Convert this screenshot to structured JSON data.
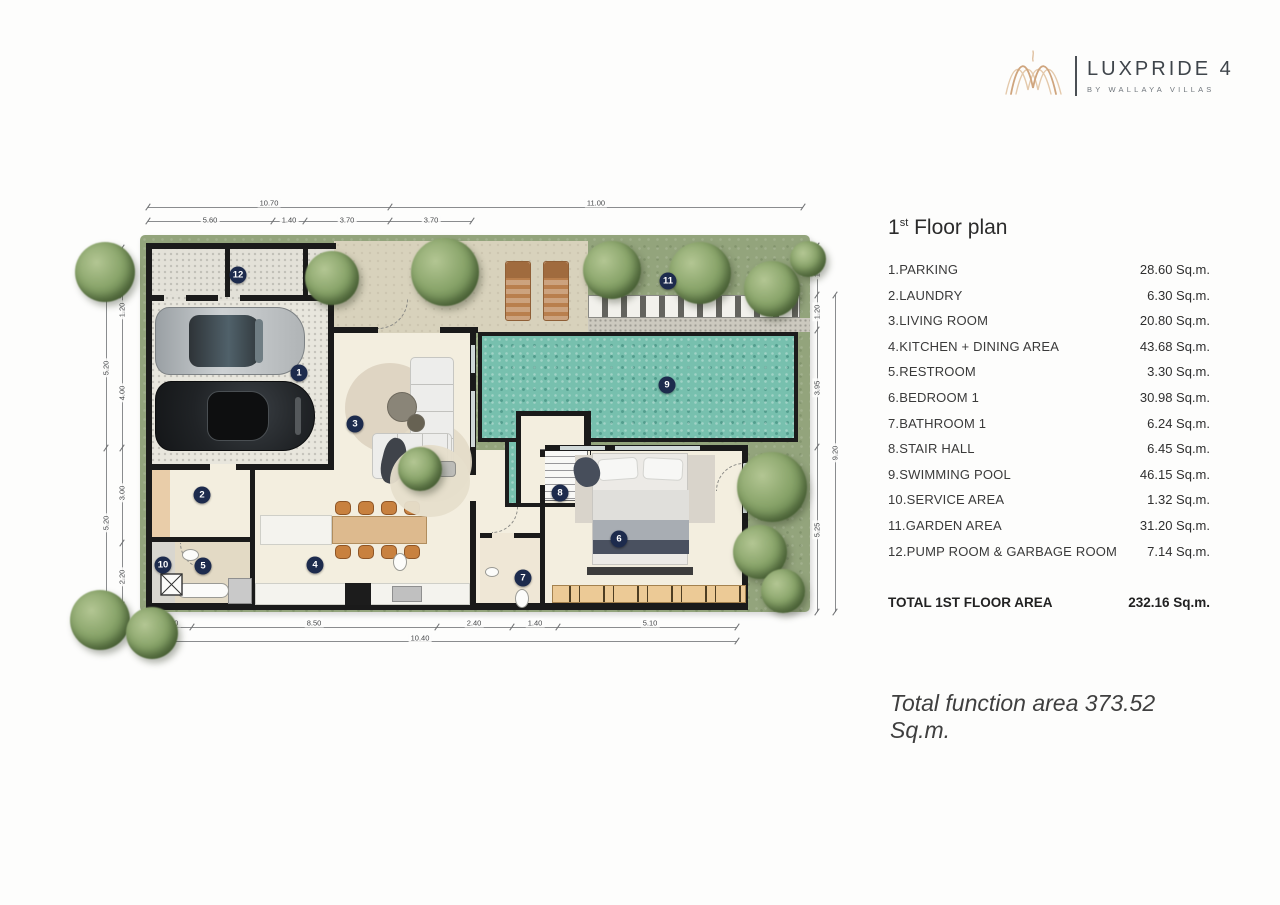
{
  "logo": {
    "brand": "LUXPRIDE 4",
    "sub": "BY WALLAYA VILLAS"
  },
  "panel": {
    "title": {
      "num": "1",
      "sup": "st",
      "rest": " Floor plan"
    },
    "items": [
      {
        "label": "1.PARKING",
        "area": "28.60 Sq.m."
      },
      {
        "label": "2.LAUNDRY",
        "area": "6.30 Sq.m."
      },
      {
        "label": "3.LIVING ROOM",
        "area": "20.80 Sq.m."
      },
      {
        "label": "4.KITCHEN + DINING AREA",
        "area": "43.68 Sq.m."
      },
      {
        "label": "5.RESTROOM",
        "area": "3.30 Sq.m."
      },
      {
        "label": "6.BEDROOM 1",
        "area": "30.98 Sq.m."
      },
      {
        "label": "7.BATHROOM 1",
        "area": "6.24 Sq.m."
      },
      {
        "label": "8.STAIR HALL",
        "area": "6.45 Sq.m."
      },
      {
        "label": "9.SWIMMING POOL",
        "area": "46.15 Sq.m."
      },
      {
        "label": "10.SERVICE AREA",
        "area": "1.32 Sq.m."
      },
      {
        "label": "11.GARDEN AREA",
        "area": "31.20 Sq.m."
      },
      {
        "label": "12.PUMP ROOM & GARBAGE ROOM",
        "area": "7.14 Sq.m."
      }
    ],
    "total_label": "TOTAL 1ST FLOOR AREA",
    "total_area": "232.16 Sq.m.",
    "total_function": "Total function area 373.52 Sq.m."
  },
  "plan": {
    "markers": [
      {
        "n": "1",
        "x": 239,
        "y": 178
      },
      {
        "n": "2",
        "x": 142,
        "y": 300
      },
      {
        "n": "3",
        "x": 295,
        "y": 229
      },
      {
        "n": "4",
        "x": 255,
        "y": 370
      },
      {
        "n": "5",
        "x": 143,
        "y": 371
      },
      {
        "n": "6",
        "x": 559,
        "y": 344
      },
      {
        "n": "7",
        "x": 463,
        "y": 383
      },
      {
        "n": "8",
        "x": 500,
        "y": 298
      },
      {
        "n": "9",
        "x": 607,
        "y": 190
      },
      {
        "n": "10",
        "x": 103,
        "y": 370
      },
      {
        "n": "11",
        "x": 608,
        "y": 86
      },
      {
        "n": "12",
        "x": 178,
        "y": 80
      }
    ],
    "dimensions": [
      {
        "v": "10.70",
        "x": 209,
        "y": 8,
        "rot": false
      },
      {
        "v": "11.00",
        "x": 536,
        "y": 8,
        "rot": false
      },
      {
        "v": "5.60",
        "x": 150,
        "y": 25,
        "rot": false
      },
      {
        "v": "1.40",
        "x": 229,
        "y": 25,
        "rot": false
      },
      {
        "v": "3.70",
        "x": 287,
        "y": 25,
        "rot": false
      },
      {
        "v": "3.70",
        "x": 371,
        "y": 25,
        "rot": false
      },
      {
        "v": "1.40",
        "x": 111,
        "y": 428,
        "rot": false
      },
      {
        "v": "8.50",
        "x": 254,
        "y": 428,
        "rot": false
      },
      {
        "v": "2.40",
        "x": 414,
        "y": 428,
        "rot": false
      },
      {
        "v": "1.40",
        "x": 475,
        "y": 428,
        "rot": false
      },
      {
        "v": "5.10",
        "x": 590,
        "y": 428,
        "rot": false
      },
      {
        "v": "10.40",
        "x": 360,
        "y": 443,
        "rot": false
      },
      {
        "v": "1.20",
        "x": 62,
        "y": 115,
        "rot": true
      },
      {
        "v": "4.00",
        "x": 62,
        "y": 198,
        "rot": true
      },
      {
        "v": "3.00",
        "x": 62,
        "y": 298,
        "rot": true
      },
      {
        "v": "2.20",
        "x": 62,
        "y": 382,
        "rot": true
      },
      {
        "v": "5.20",
        "x": 46,
        "y": 173,
        "rot": true
      },
      {
        "v": "5.20",
        "x": 46,
        "y": 328,
        "rot": true
      },
      {
        "v": "1.65",
        "x": 757,
        "y": 75,
        "rot": true
      },
      {
        "v": "1.20",
        "x": 757,
        "y": 117,
        "rot": true
      },
      {
        "v": "3.95",
        "x": 757,
        "y": 193,
        "rot": true
      },
      {
        "v": "5.25",
        "x": 757,
        "y": 335,
        "rot": true
      },
      {
        "v": "9.20",
        "x": 775,
        "y": 258,
        "rot": true
      }
    ],
    "colors": {
      "lawn": "#93a47c",
      "pool": "#77c0ae",
      "wall": "#1a1a1a",
      "floor": "#f3eedf",
      "marker": "#1d2b4d"
    }
  }
}
